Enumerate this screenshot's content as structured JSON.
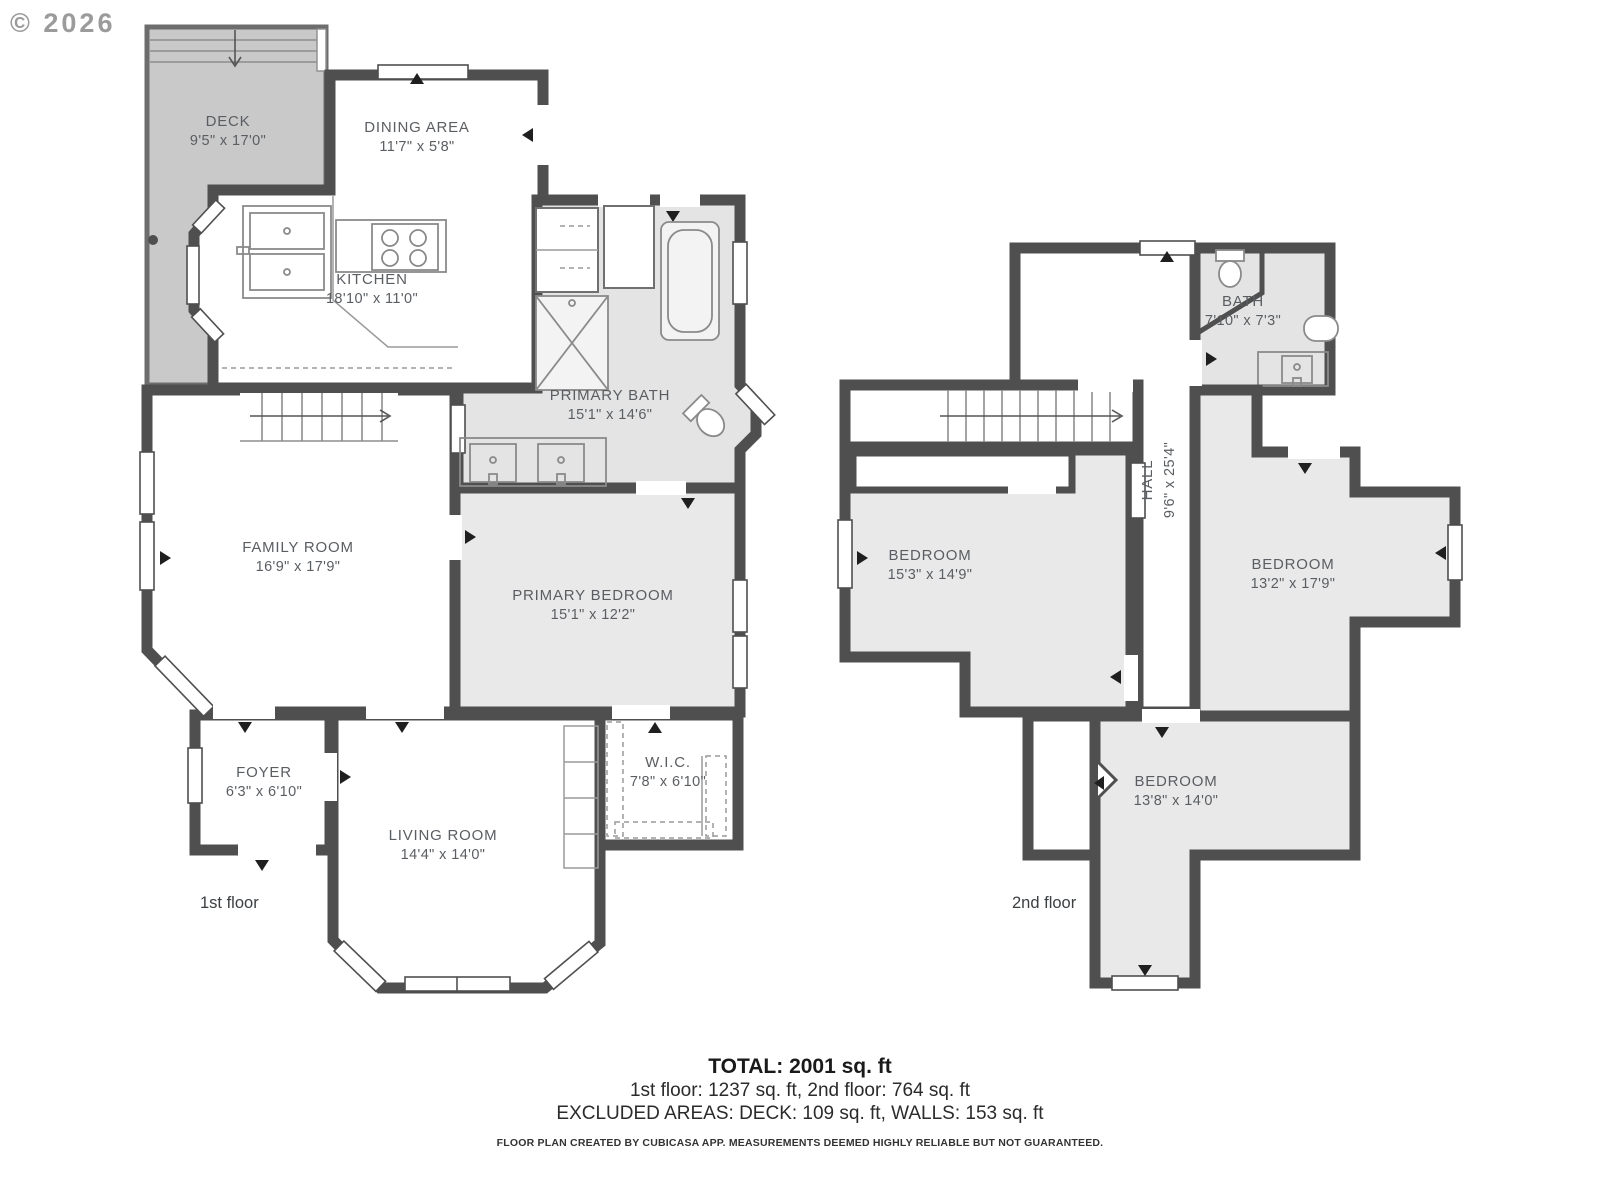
{
  "copyright": "© 2026",
  "colors": {
    "wall": "#4f4f4f",
    "room_shaded": "#e9e9e9",
    "deck": "#c9c9c9",
    "label_text": "#5a5e62"
  },
  "floors": {
    "first": {
      "label": "1st floor",
      "rooms": [
        {
          "name": "DECK",
          "dims": "9'5\" x 17'0\""
        },
        {
          "name": "DINING AREA",
          "dims": "11'7\" x 5'8\""
        },
        {
          "name": "KITCHEN",
          "dims": "18'10\" x 11'0\""
        },
        {
          "name": "PRIMARY BATH",
          "dims": "15'1\" x 14'6\""
        },
        {
          "name": "FAMILY ROOM",
          "dims": "16'9\" x 17'9\""
        },
        {
          "name": "PRIMARY BEDROOM",
          "dims": "15'1\" x 12'2\""
        },
        {
          "name": "FOYER",
          "dims": "6'3\" x 6'10\""
        },
        {
          "name": "LIVING ROOM",
          "dims": "14'4\" x 14'0\""
        },
        {
          "name": "W.I.C.",
          "dims": "7'8\" x 6'10\""
        }
      ]
    },
    "second": {
      "label": "2nd floor",
      "rooms": [
        {
          "name": "BATH",
          "dims": "7'10\" x 7'3\""
        },
        {
          "name": "HALL",
          "dims": "9'6\" x 25'4\""
        },
        {
          "name": "BEDROOM",
          "dims": "15'3\" x 14'9\""
        },
        {
          "name": "BEDROOM",
          "dims": "13'2\" x 17'9\""
        },
        {
          "name": "BEDROOM",
          "dims": "13'8\" x 14'0\""
        }
      ]
    }
  },
  "summary": {
    "total": "TOTAL: 2001 sq. ft",
    "floors_line": "1st floor: 1237 sq. ft, 2nd floor: 764 sq. ft",
    "excluded_line": "EXCLUDED AREAS: DECK: 109 sq. ft, WALLS: 153 sq. ft"
  },
  "disclaimer": "FLOOR PLAN CREATED BY CUBICASA APP. MEASUREMENTS DEEMED HIGHLY RELIABLE BUT NOT GUARANTEED."
}
